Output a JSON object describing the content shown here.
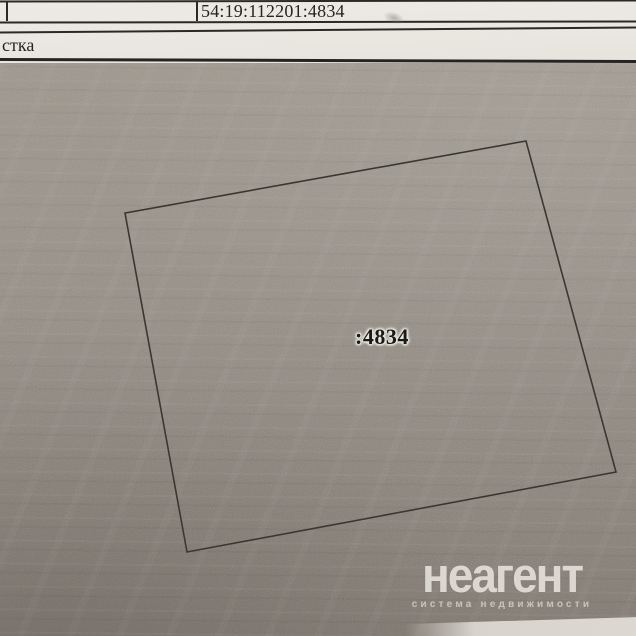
{
  "page": {
    "header": {
      "cadastral_number": "54:19:112201:4834",
      "partial_word": "стка"
    },
    "plan": {
      "parcel_label": ":4834",
      "polygon_points": "125,213 526,141 616,472 187,552"
    },
    "watermark": {
      "brand": "неагент",
      "tagline": "система недвижимости"
    },
    "colors": {
      "paper": "#ebe8e2",
      "plan_gray": "#8f8a83",
      "table_line": "#2b2924",
      "parcel_line": "#3a3733",
      "watermark_text": "#f0ede6"
    }
  }
}
